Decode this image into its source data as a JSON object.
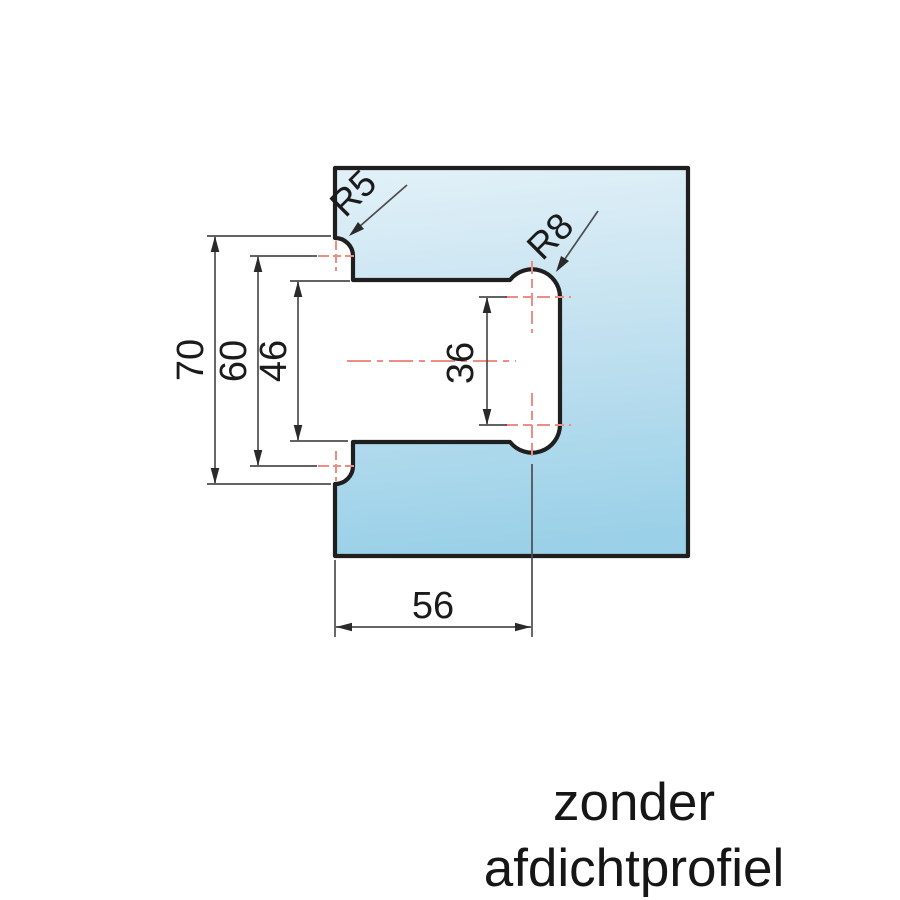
{
  "drawing": {
    "type": "technical-dimension-drawing",
    "subject": "glass hinge cutout profile",
    "dimensions": {
      "opening_height": "70",
      "center_span": "60",
      "slot_height": "46",
      "drill_center_span": "36",
      "depth": "56"
    },
    "radii": {
      "edge_fillet": "R5",
      "inner_fillet": "R8"
    },
    "caption": {
      "line1": "zonder",
      "line2": "afdichtprofiel"
    },
    "colors": {
      "background": "#ffffff",
      "glass_gradient_top": "#e1f0f7",
      "glass_gradient_bottom": "#9dd2e9",
      "outline": "#1f1f1f",
      "dimension_lines": "#4d4d4d",
      "centerlines": "#ef8c84",
      "text": "#1b1b1b"
    }
  }
}
